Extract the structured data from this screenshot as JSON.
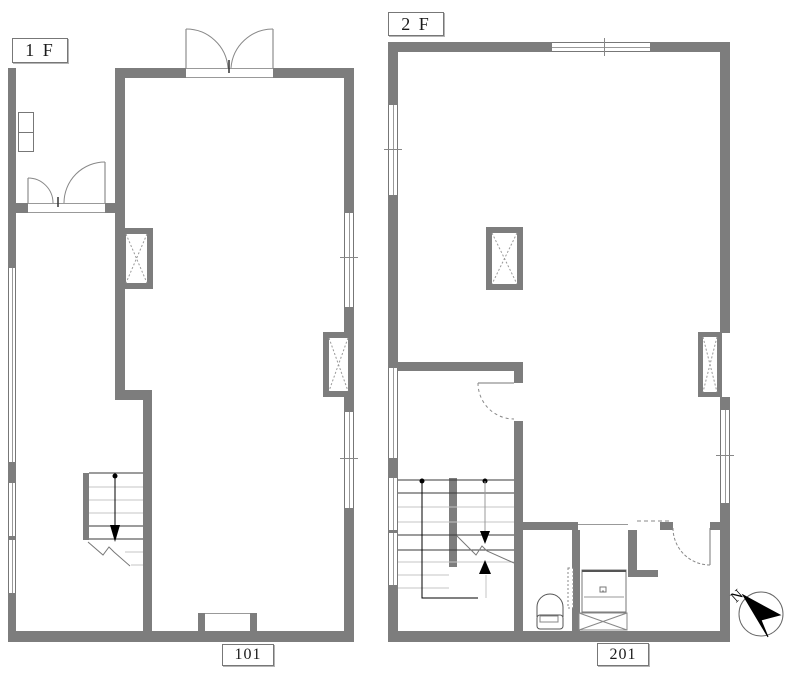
{
  "floors": {
    "f1": {
      "label": "1 F",
      "room": "101"
    },
    "f2": {
      "label": "2 F",
      "room": "201"
    }
  },
  "compass": {
    "label": "N"
  },
  "colors": {
    "wall": "#7d7d7d",
    "line": "#555555",
    "light_line": "#c4c4c4",
    "arrow": "#000000",
    "background": "#ffffff"
  }
}
